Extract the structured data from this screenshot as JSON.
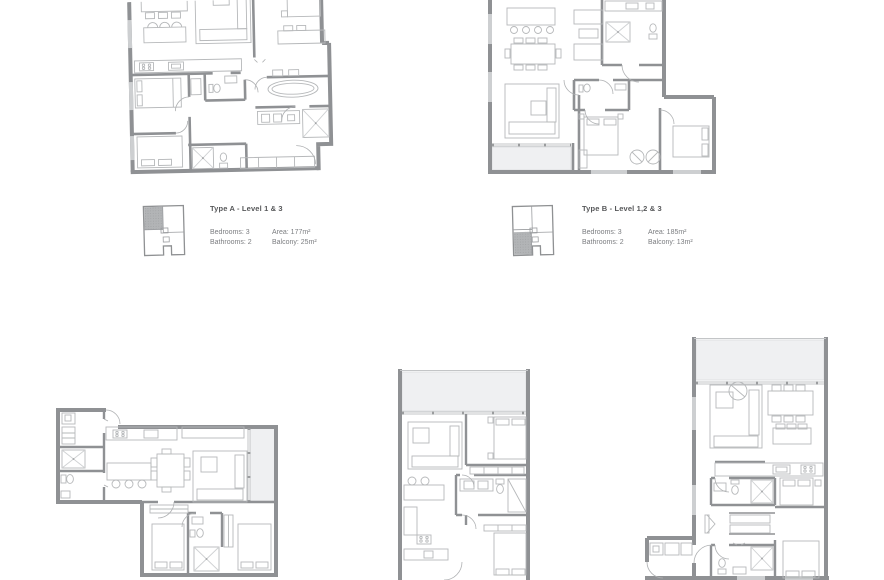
{
  "units": [
    {
      "title": "Type A - Level 1 & 3",
      "bedrooms": "Bedrooms: 3",
      "bathrooms": "Bathrooms: 2",
      "area": "Area: 177m²",
      "balcony": "Balcony: 25m²",
      "keyplan_highlight": "top-left-quadrant"
    },
    {
      "title": "Type B - Level 1,2 & 3",
      "bedrooms": "Bedrooms: 3",
      "bathrooms": "Bathrooms: 2",
      "area": "Area: 185m²",
      "balcony": "Balcony: 13m²",
      "keyplan_highlight": "bottom-left-quadrant"
    }
  ],
  "colors": {
    "wall": "#8f9194",
    "wall_window": "#cdcfd1",
    "furniture_line": "#b6b8ba",
    "door_arc": "#aeb0b2",
    "balcony_fill": "#eff0f2",
    "keyplan_shade": "#b2b4b6",
    "title_text": "#57585a",
    "detail_text": "#7b7d80",
    "background": "#ffffff"
  }
}
